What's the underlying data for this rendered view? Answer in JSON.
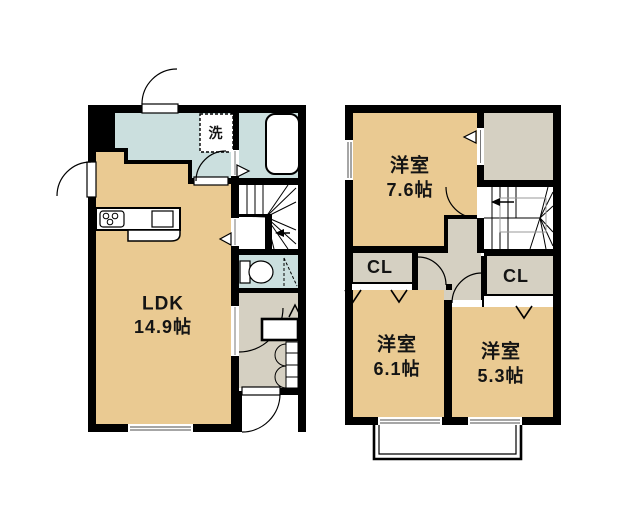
{
  "floor1": {
    "ldk_name": "LDK",
    "ldk_size": "14.9帖",
    "laundry": "洗"
  },
  "floor2": {
    "room1_name": "洋室",
    "room1_size": "7.6帖",
    "room2_name": "洋室",
    "room2_size": "6.1帖",
    "room3_name": "洋室",
    "room3_size": "5.3帖",
    "closet_left": "CL",
    "closet_right": "CL"
  },
  "colors": {
    "room": "#EACA92",
    "wet_area": "#CBDFDE",
    "hall": "#D5D0C2",
    "wall": "#000000",
    "background": "#FFFFFF"
  }
}
